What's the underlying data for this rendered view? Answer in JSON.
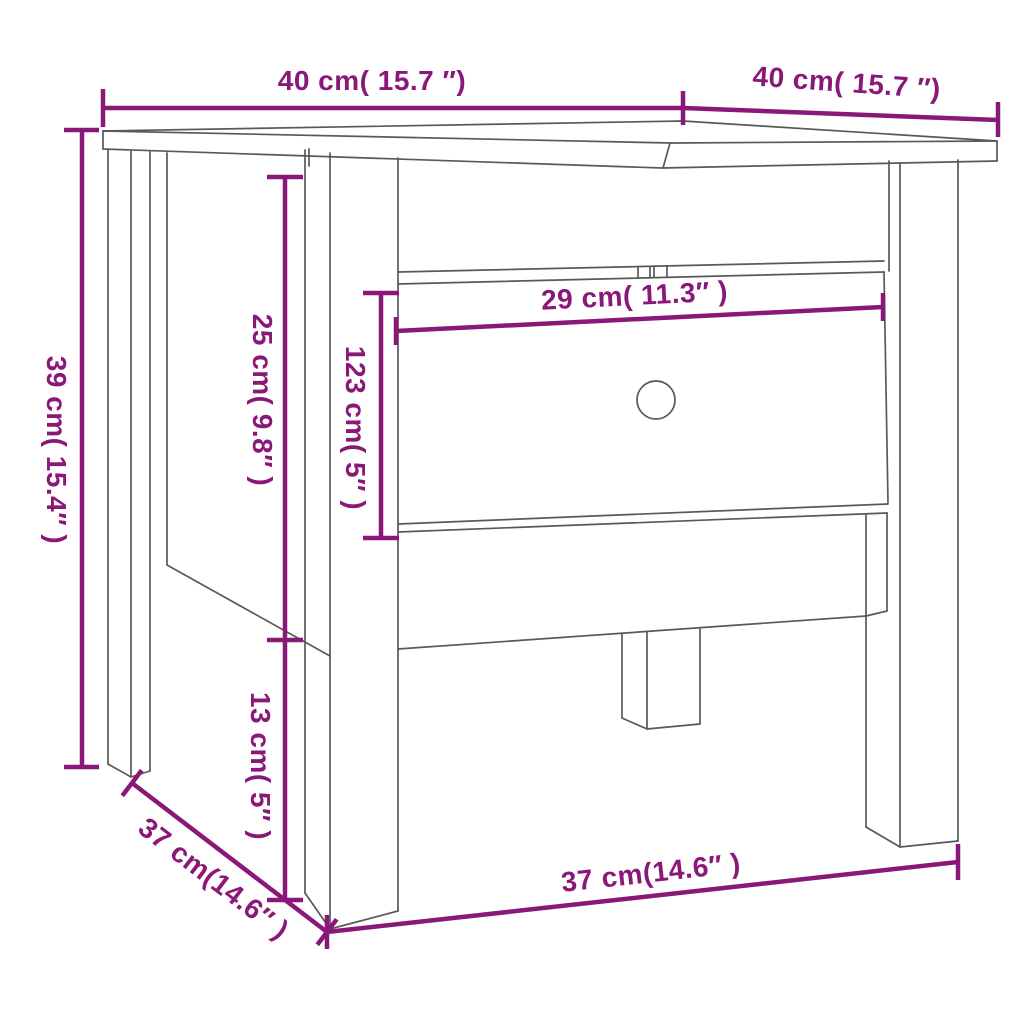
{
  "figure": {
    "subject": "side table with drawer",
    "view": "perspective line drawing with dimension annotations"
  },
  "colors": {
    "annotation": "#8a1878",
    "outline": "#595959",
    "background": "#ffffff"
  },
  "dimension_labels": {
    "tabletop_width": "40 cm( 15.7 ″)",
    "tabletop_depth": "40 cm( 15.7 ″)",
    "total_height": "39 cm( 15.4″ )",
    "upper_section_height": "25 cm( 9.8″ )",
    "drawer_front_height": "123 cm( 5″ )",
    "drawer_front_width": "29 cm( 11.3″ )",
    "leg_bottom_height": "13 cm( 5″ )",
    "base_depth": "37 cm(14.6″ )",
    "base_width": "37 cm(14.6″ )"
  }
}
